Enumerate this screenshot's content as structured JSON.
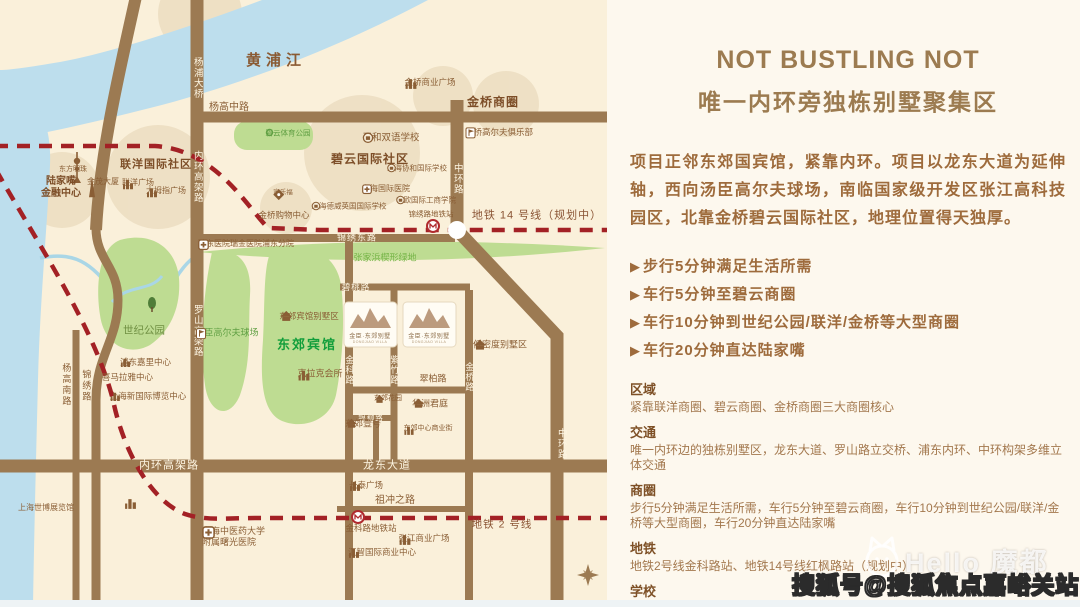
{
  "map": {
    "labels": {
      "huangpu": "黄浦江",
      "yangpu_bridge": "杨浦大桥",
      "neihuan_v": "内环高架路",
      "neihuan_h": "内环高架路",
      "luoshan": "罗山高架路",
      "yanggaozhong": "杨高中路",
      "yanggaonan": "杨高南路",
      "jinxiu_lu": "锦绣路",
      "zhonghuan_a": "中环路",
      "zhonghuan_b": "中环路",
      "longdong": "龙东大道",
      "jinxiudong": "锦绣东路",
      "bitao": "碧桃路",
      "jinke_lu": "金科路",
      "zizhu": "紫竹路",
      "cuibai": "翠柏路",
      "jinqiao_lu": "金桥路",
      "yinliu": "银柳路",
      "zuchongzhi": "祖冲之路",
      "metro14": "地铁 14 号线（规划中）",
      "metro2": "地铁 2 号线",
      "lujiazui_1": "陆家嘴",
      "lujiazui_2": "金融中心",
      "dongfangmingzhu": "东方明珠",
      "jinmao": "金茂大厦",
      "lianyang_shequ": "联洋国际社区",
      "lianyang_plaza": "联洋广场",
      "damuzhi": "大拇指广场",
      "biyun_sports": "碧云体育公园",
      "shiji_park": "世纪公园",
      "pinghe": "平和双语学校",
      "biyun_shequ": "碧云国际社区",
      "xiehe": "上海协和国际学校",
      "intl_hospital": "上海国际医院",
      "dewei": "上海德威英国国际学校",
      "zhongou": "中欧国际工商学院",
      "jinxiu_station": "锦绣路地铁站",
      "jialefu": "家乐福",
      "jinqiao_mall": "金桥购物中心",
      "jinqiao_plaza": "金桥商业广场",
      "jinqiao_shangquan": "金桥商圈",
      "jinqiao_golf": "金桥高尔夫俱乐部",
      "ruidong": "瑞东医院瑞金医院浦东分院",
      "zhangjiabang": "张家浜楔形绿地",
      "tangchen": "汤臣高尔夫球场",
      "dj_bieshuqu": "东郊宾馆别墅区",
      "dj_binguan": "东郊宾馆",
      "kelake": "克拉克会所",
      "kerry": "浦东嘉里中心",
      "ximalaya": "喜马拉雅中心",
      "expo_center": "上海新国际博览中心",
      "lowdensity": "低密度别墅区",
      "dj_garden": "东郊花园",
      "huazhou": "华洲君庭",
      "dj_one": "东郊壹号",
      "dj_biz": "东郊中心商业街",
      "changtai": "长泰广场",
      "jinke_station": "金科路地铁站",
      "zhangjiang_plaza": "张江商业广场",
      "huizhi": "汇智国际商业中心",
      "expo_hall": "上海世博展览馆",
      "shuguang_1": "上海中医药大学",
      "shuguang_2": "附属曙光医院",
      "logo_cn": "金臣·东郊别墅",
      "logo_en": "DONGJIAO VILLA"
    },
    "colors": {
      "road": "#9c7a52",
      "river": "#bddeed",
      "park": "#bedc92",
      "metro_red": "#a32125",
      "highlight_tan": "#e7d7b8",
      "project_green": "#129e3b"
    }
  },
  "panel": {
    "title_en": "NOT BUSTLING NOT",
    "title_zh": "唯一内环旁独栋别墅聚集区",
    "intro": "项目正邻东郊国宾馆，紧靠内环。项目以龙东大道为延伸轴，西向汤臣高尔夫球场，南临国家级开发区张江高科技园区，北靠金桥碧云国际社区，地理位置得天独厚。",
    "bullet_icon": "▶",
    "bullets": [
      "步行5分钟满足生活所需",
      "车行5分钟至碧云商圈",
      "车行10分钟到世纪公园/联洋/金桥等大型商圈",
      "车行20分钟直达陆家嘴"
    ],
    "sections": [
      {
        "heading": "区域",
        "body": "紧靠联洋商圈、碧云商圈、金桥商圈三大商圈核心"
      },
      {
        "heading": "交通",
        "body": "唯一内环边的独栋别墅区，龙东大道、罗山路立交桥、浦东内环、中环构架多维立体交通"
      },
      {
        "heading": "商圈",
        "body": "步行5分钟满足生活所需，车行5分钟至碧云商圈，车行10分钟到世纪公园/联洋/金桥等大型商圈，车行20分钟直达陆家嘴"
      },
      {
        "heading": "地铁",
        "body": "地铁2号线金科路站、地铁14号线红枫路站（规划中）"
      },
      {
        "heading": "学校",
        "body": "协和国际学校、平和双语学校、中欧国际工商学院、德威国际学校"
      }
    ]
  },
  "watermark": {
    "hello": "Hello 魔都",
    "souhu": "搜狐号@搜狐焦点嘉峪关站"
  }
}
